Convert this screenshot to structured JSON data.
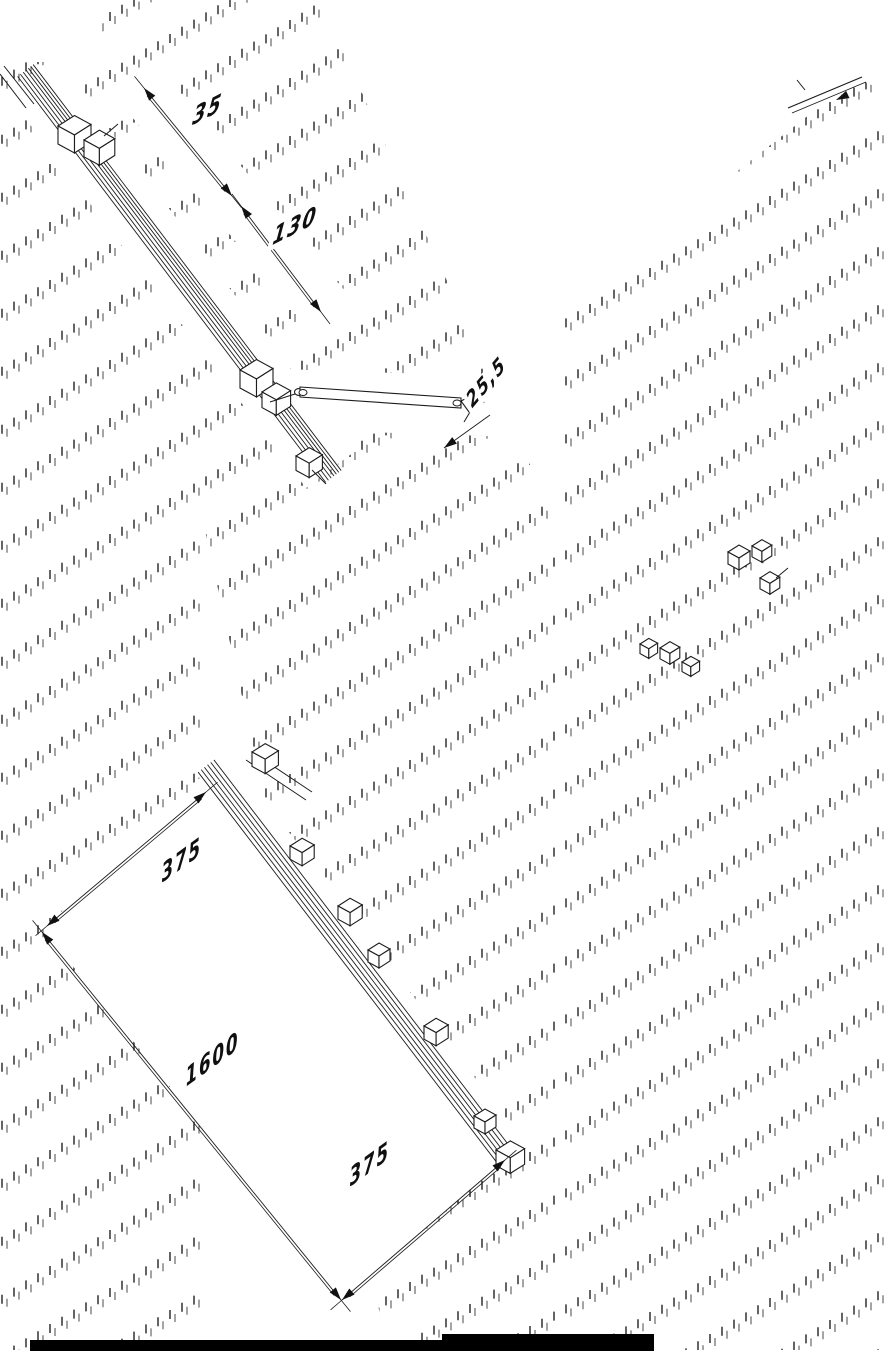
{
  "drawing": {
    "type": "isometric-assembly-drawing",
    "colors": {
      "background": "#ffffff",
      "line": "#1c1c1c",
      "hatch_dark": "#222222",
      "hatch_light": "#5a5a5a"
    },
    "dims": {
      "a": "35",
      "b": "130",
      "c": "25,5",
      "d": "375",
      "e": "1600",
      "f": "375"
    },
    "icons": {
      "dimension-arrow": "filled-triangle",
      "pivot-eye": "small-ellipse"
    }
  }
}
